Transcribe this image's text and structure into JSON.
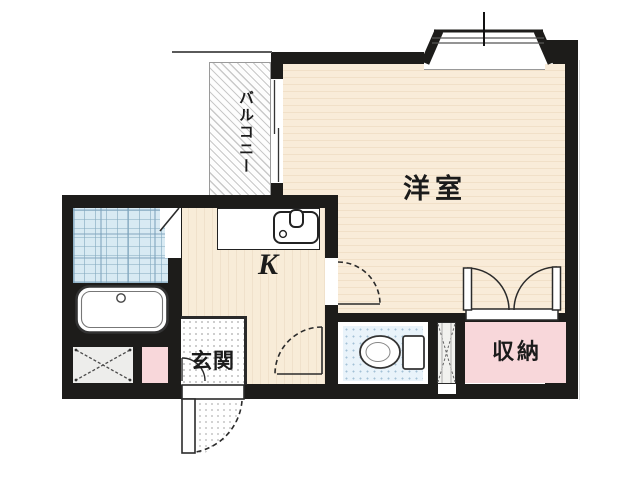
{
  "floorplan": {
    "type": "japanese-apartment-1K",
    "rooms": {
      "balcony": {
        "label": "バルコニー"
      },
      "western_room": {
        "label": "洋室"
      },
      "kitchen": {
        "label": "K"
      },
      "entrance": {
        "label": "玄関"
      },
      "storage": {
        "label": "収納"
      }
    },
    "fixtures": [
      "bay-window",
      "balcony-sliding-window",
      "bathtub",
      "bathroom-tile-area",
      "washing-machine-pan",
      "kitchen-counter",
      "kitchen-sink",
      "toilet",
      "pipe-space",
      "entrance-door",
      "storage-double-doors",
      "room-door",
      "toilet-door"
    ],
    "colors": {
      "wall": "#1d1c1a",
      "western_room_floor": "#f9ecd9",
      "kitchen_floor": "#f8ecd8",
      "storage_pink": "#f8d7da",
      "utility_pink": "#f8d7da",
      "bath_tile_blue": "#d8eaf3",
      "toilet_floor_blue": "#e9f3fa",
      "door_line": "#2b2b2b",
      "background": "#ffffff"
    }
  }
}
